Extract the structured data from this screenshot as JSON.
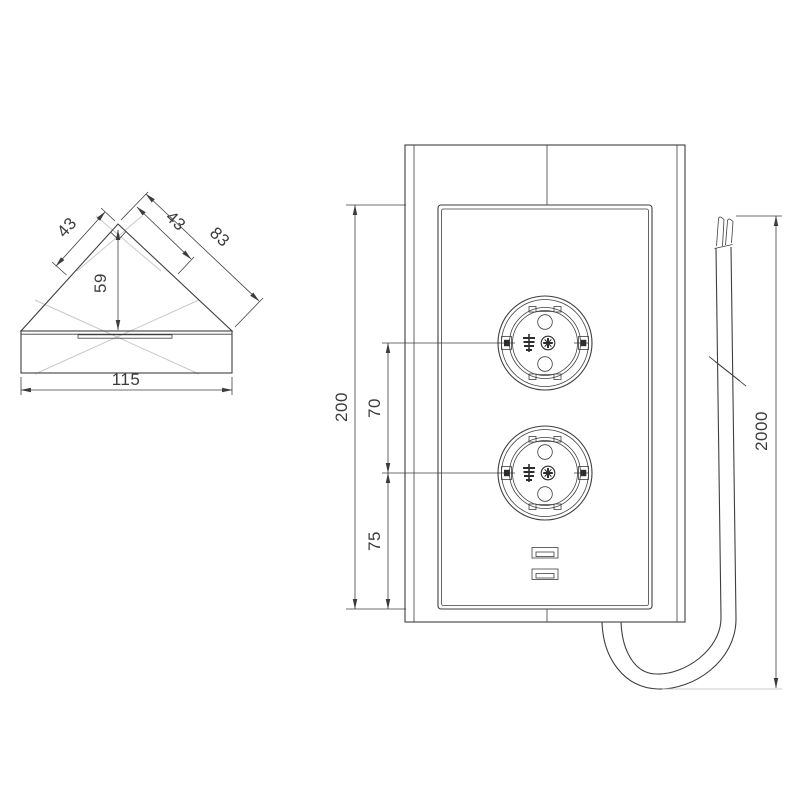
{
  "page": {
    "background": "#ffffff",
    "type": "technical-drawing-corner-power-socket"
  },
  "views": {
    "top_view": {
      "title": "corner-unit-top-view",
      "dims": {
        "left_edge": "43",
        "right_edge_upper": "43",
        "right_edge_total": "83",
        "apex_height": "59",
        "base_width": "115"
      }
    },
    "front_view": {
      "title": "power-unit-front-view",
      "dims": {
        "panel_height": "200",
        "socket_spacing": "70",
        "lower_socket_to_bottom": "75",
        "cable_length": "2000"
      }
    }
  },
  "colors": {
    "line": "#3f3f3f",
    "centerline": "#c7cbc7",
    "dimension_text": "#3c3c3c",
    "background": "#ffffff"
  }
}
